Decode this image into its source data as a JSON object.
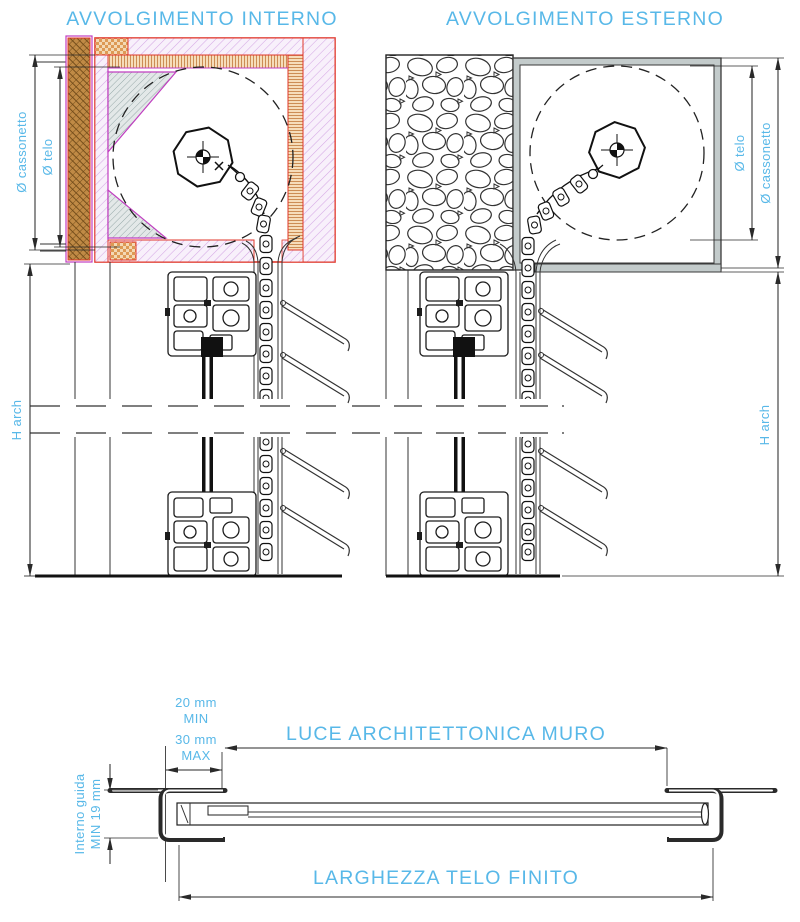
{
  "colors": {
    "accent_blue": "#58b8e8",
    "red": "#e0372b",
    "magenta": "#c03ec0",
    "pink_fill": "#f8f0fb",
    "pink_line": "#d5a8e5",
    "brown_fill": "#c08a45",
    "brown_line": "#6e4817",
    "orange_checker": "#dd9a55",
    "grain_fill": "#f6ddba",
    "grain_line": "#c2793a",
    "gray_fill": "#c3cbcb",
    "gray_hatch_fill": "#e3e8e8",
    "gray_hatch_line": "#8fa2a2",
    "line_dark": "#2a2a2a"
  },
  "drawings": {
    "internal": {
      "title": "AVVOLGIMENTO INTERNO",
      "dim_cassonetto": "Ø cassonetto",
      "dim_telo": "Ø telo",
      "dim_height": "H arch"
    },
    "external": {
      "title": "AVVOLGIMENTO ESTERNO",
      "dim_telo": "Ø telo",
      "dim_cassonetto": "Ø cassonetto",
      "dim_height": "H arch"
    },
    "plan": {
      "offset_value_min": "20 mm",
      "offset_min_label": "MIN",
      "offset_value_max": "30 mm",
      "offset_max_label": "MAX",
      "wall_opening_label": "LUCE ARCHITETTONICA MURO",
      "guide_label_line1": "Interno guida",
      "guide_label_line2": "MIN 19 mm",
      "curtain_width_label": "LARGHEZZA TELO FINITO"
    }
  }
}
